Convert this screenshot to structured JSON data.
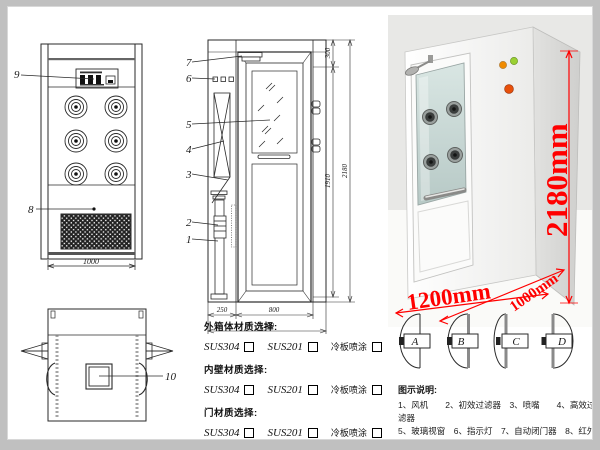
{
  "front_view": {
    "callout_9": "9",
    "callout_8": "8",
    "dim_width": "1000"
  },
  "section_view": {
    "callouts": [
      "7",
      "6",
      "5",
      "4",
      "3",
      "2",
      "1"
    ],
    "dim_top": "300",
    "dim_door_height": "1910",
    "dim_total_height": "2180",
    "dim_left": "250",
    "dim_door_width": "800",
    "dim_total_width": "1200"
  },
  "top_view": {
    "callout_10": "10"
  },
  "photo": {
    "dim_height": "2180mm",
    "dim_width": "1200mm",
    "dim_depth": "1000mm",
    "dim_color": "#ff0000",
    "indicators": [
      {
        "name": "amber-button",
        "color": "#f08b00"
      },
      {
        "name": "green-button",
        "color": "#9ad032"
      },
      {
        "name": "red-button",
        "color": "#e8500a"
      }
    ]
  },
  "materials": {
    "sections": [
      {
        "title": "外箱体材质选择:"
      },
      {
        "title": "内壁材质选择:"
      },
      {
        "title": "门材质选择:"
      }
    ],
    "options": [
      "SUS304",
      "SUS201",
      "冷板喷涂"
    ]
  },
  "door_types": {
    "labels": [
      "A",
      "B",
      "C",
      "D"
    ]
  },
  "legend": {
    "title": "图示说明:",
    "lines": [
      "1、风机　　2、初效过滤器　3、喷嘴　　4、高效过滤器",
      "5、玻璃视窗　6、指示灯　7、自动闭门器　8、红外线感应器",
      "9、控制面板　　10、照明灯"
    ]
  }
}
